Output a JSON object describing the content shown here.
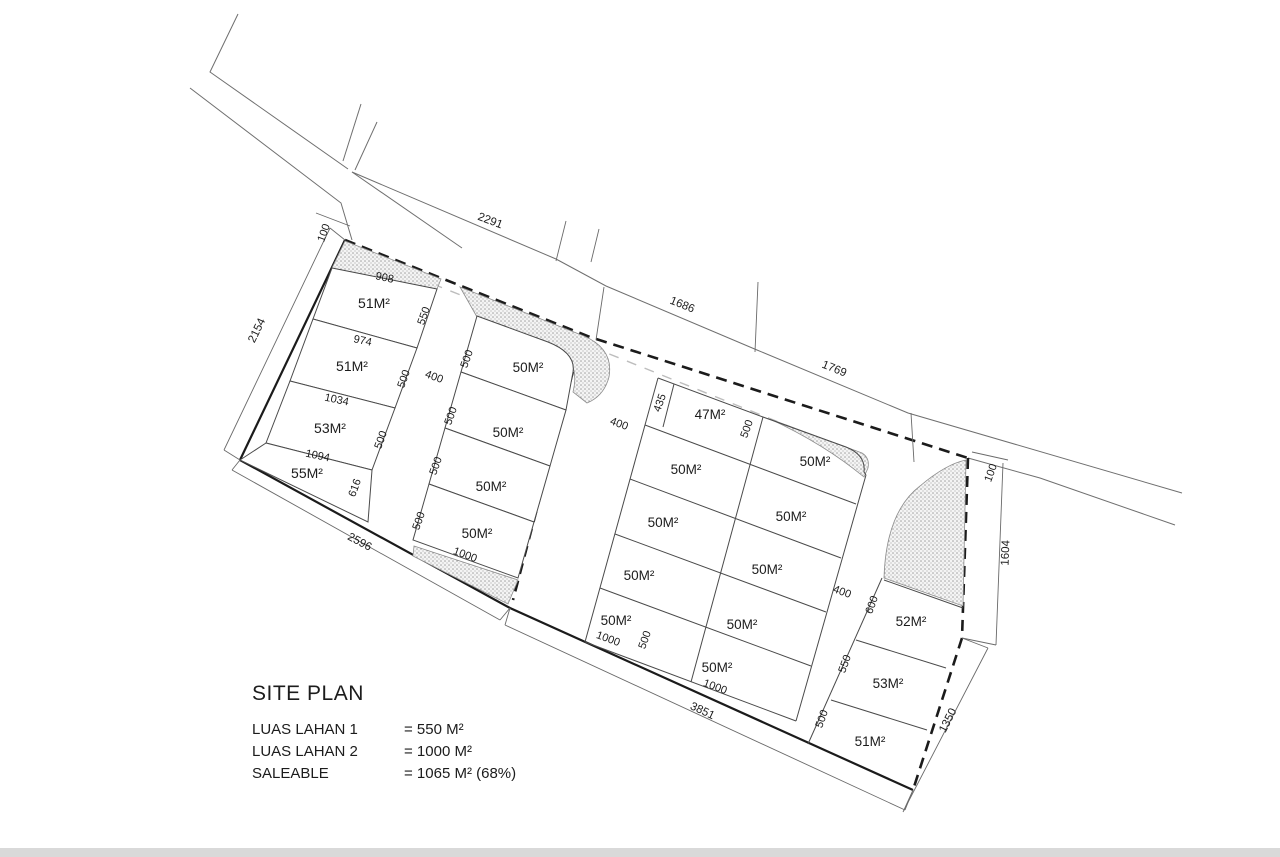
{
  "legend": {
    "title": "SITE PLAN",
    "items": [
      {
        "label": "LUAS LAHAN 1",
        "value": "= 550 M²"
      },
      {
        "label": "LUAS LAHAN 2",
        "value": "= 1000 M²"
      },
      {
        "label": "SALEABLE",
        "value": "= 1065 M² (68%)"
      }
    ]
  },
  "dims": {
    "top_offset": "100",
    "top_road": "2291",
    "left": "2154",
    "bottom_left": "2596",
    "bottom": "3851",
    "top_mid": "1686",
    "top_right": "1769",
    "right_offset": "100",
    "right": "1604",
    "bottom_right": "1350",
    "gap_ab": "400",
    "gap_bc": "400",
    "gap_cd": "400"
  },
  "block_a": {
    "lots": [
      {
        "area": "51M²",
        "width": "908",
        "depth": "550"
      },
      {
        "area": "51M²",
        "width": "974",
        "depth": "500"
      },
      {
        "area": "53M²",
        "width": "1034",
        "depth": "500"
      },
      {
        "area": "55M²",
        "width": "1094",
        "depth": "616"
      }
    ]
  },
  "block_b": {
    "width": "1000",
    "lots": [
      {
        "area": "50M²",
        "depth": "500"
      },
      {
        "area": "50M²",
        "depth": "500"
      },
      {
        "area": "50M²",
        "depth": "500"
      },
      {
        "area": "50M²",
        "depth": "500"
      }
    ]
  },
  "block_c": {
    "col1": {
      "width": "1000",
      "front_depth": "500",
      "bottom_depth": "500",
      "lots": [
        {
          "area": "47M²",
          "depth": "435"
        },
        {
          "area": "50M²"
        },
        {
          "area": "50M²"
        },
        {
          "area": "50M²"
        },
        {
          "area": "50M²"
        }
      ]
    },
    "col2": {
      "width": "1000",
      "lots": [
        {
          "area": "50M²"
        },
        {
          "area": "50M²"
        },
        {
          "area": "50M²"
        },
        {
          "area": "50M²"
        },
        {
          "area": "50M²"
        }
      ]
    }
  },
  "block_d": {
    "lots": [
      {
        "area": "52M²",
        "depth": "600"
      },
      {
        "area": "53M²",
        "depth": "550"
      },
      {
        "area": "51M²",
        "depth": "500"
      }
    ]
  },
  "colors": {
    "footer_bar": "#d9d9d9"
  }
}
